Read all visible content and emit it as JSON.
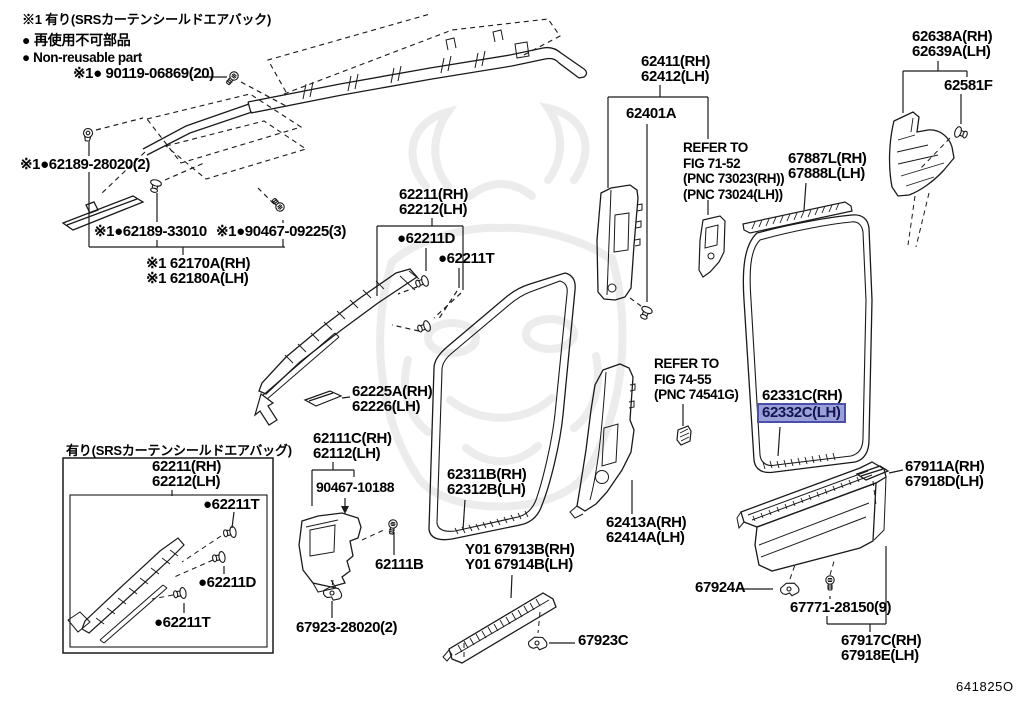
{
  "colors": {
    "ink": "#1a1a1a",
    "wm": "#ececec",
    "highlight_bg": "#99a0da",
    "highlight_border": "#4a50a8",
    "highlight_text": "#14144e"
  },
  "header_notes": {
    "srs": "※1 有り(SRSカーテンシールドエアバック)",
    "nonreusable_jp": "● 再使用不可部品",
    "nonreusable_en": "● Non-reusable part"
  },
  "diagram_code": "641825O",
  "labels": {
    "bolt_90119": "※1● 90119-06869(20)",
    "grommet_62189_28020": "※1●62189-28020(2)",
    "clip_62189_33010": "※1●62189-33010",
    "screw_90467_09225": "※1●90467-09225(3)",
    "rail_62170a": [
      "※1 62170A(RH)",
      "※1 62180A(LH)"
    ],
    "pillar_62211": [
      "62211(RH)",
      "62212(LH)"
    ],
    "clip_62211d": "●62211D",
    "clip_62211t": "●62211T",
    "garnish_62225a": [
      "62225A(RH)",
      "62226(LH)"
    ],
    "trim_62111c": [
      "62111C(RH)",
      "62112(LH)"
    ],
    "clip_90467_10188": "90467-10188",
    "bolt_62111b": "62111B",
    "clip_67923_28020": "67923-28020(2)",
    "trim_62311b": [
      "62311B(RH)",
      "62312B(LH)"
    ],
    "plate_67913b": [
      "Y01 67913B(RH)",
      "Y01 67914B(LH)"
    ],
    "clip_67923c": "67923C",
    "pillar_62411": [
      "62411(RH)",
      "62412(LH)"
    ],
    "pillar_62401a": "62401A",
    "refer_fig_71_52": [
      "REFER TO",
      "FIG 71-52",
      "(PNC 73023(RH))",
      "(PNC 73024(LH))"
    ],
    "garnish_67887l": [
      "67887L(RH)",
      "67888L(LH)"
    ],
    "pillar_62638a": [
      "62638A(RH)",
      "62639A(LH)"
    ],
    "clip_62581f": "62581F",
    "refer_fig_74_55": [
      "REFER TO",
      "FIG 74-55",
      "(PNC 74541G)"
    ],
    "trim_62331c": "62331C(RH)",
    "trim_62332c": "62332C(LH)",
    "pillar_62413a": [
      "62413A(RH)",
      "62414A(LH)"
    ],
    "garnish_67911a": [
      "67911A(RH)",
      "67918D(LH)"
    ],
    "clip_67924a": "67924A",
    "screw_67771_28150": "67771-28150(9)",
    "plate_67917c": [
      "67917C(RH)",
      "67918E(LH)"
    ]
  },
  "inset": {
    "title": "有り(SRSカーテンシールドエアバッグ)",
    "pillar_62211": [
      "62211(RH)",
      "62212(LH)"
    ],
    "clip_62211t_upper": "●62211T",
    "clip_62211d": "●62211D",
    "clip_62211t_lower": "●62211T"
  }
}
